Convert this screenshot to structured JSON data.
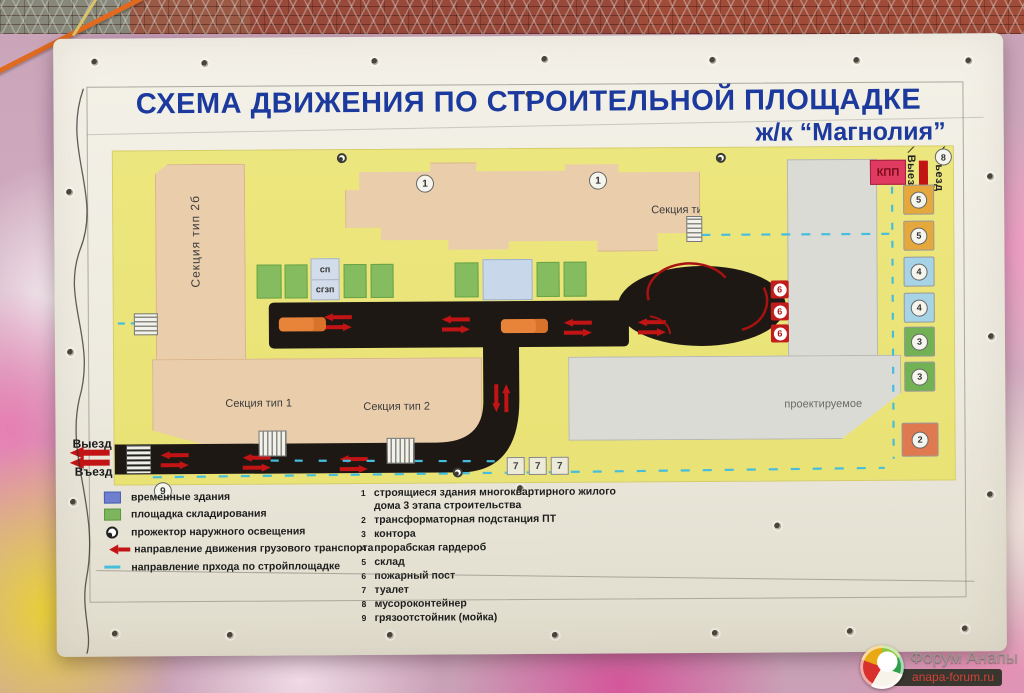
{
  "title": {
    "line1": "СХЕМА ДВИЖЕНИЯ ПО СТРОИТЕЛЬНОЙ ПЛОЩАДКЕ",
    "line2": "ж/к “Магнолия”"
  },
  "map": {
    "section_2b": "Секция тип 2б",
    "section_2a": "Секция тип 2а",
    "section_1": "Секция тип 1",
    "section_2": "Секция тип 2",
    "projected": "проектируемое",
    "sp": "сп",
    "sgzp": "сгзп",
    "kpp": "КПП",
    "gate_top": {
      "exit": "Выезд",
      "entry": "Въезд",
      "badge": "8"
    },
    "gate_left": {
      "exit": "Выезд",
      "entry": "Въезд",
      "badge": "9"
    },
    "building_marks": [
      "1",
      "1"
    ],
    "fire_posts": [
      "6",
      "6",
      "6"
    ],
    "toilets": [
      "7",
      "7",
      "7"
    ],
    "right_boxes": [
      {
        "num": "5",
        "color": "#e4a83c"
      },
      {
        "num": "5",
        "color": "#e4a83c"
      },
      {
        "num": "4",
        "color": "#a6d3e6"
      },
      {
        "num": "4",
        "color": "#a6d3e6"
      },
      {
        "num": "3",
        "color": "#72b254"
      },
      {
        "num": "3",
        "color": "#72b254"
      },
      {
        "num": "2",
        "color": "#df7950"
      }
    ]
  },
  "legend_left": [
    {
      "swatch": "blue-square",
      "label": "временные здания"
    },
    {
      "swatch": "green-square",
      "label": "площадка складирования"
    },
    {
      "swatch": "floodlight",
      "label": "прожектор наружного освещения"
    },
    {
      "swatch": "red-arrow",
      "label": "направление движения грузового транспорта"
    },
    {
      "swatch": "blue-dash",
      "label": "направление прхода по стройплощадке"
    }
  ],
  "legend_right": [
    {
      "num": "1",
      "label": "строящиеся здания многоквартирного жилого дома 3 этапа строительства"
    },
    {
      "num": "2",
      "label": "трансформаторная подстанция ПТ"
    },
    {
      "num": "3",
      "label": "контора"
    },
    {
      "num": "4",
      "label": "прорабская гардероб"
    },
    {
      "num": "5",
      "label": "склад"
    },
    {
      "num": "6",
      "label": "пожарный пост"
    },
    {
      "num": "7",
      "label": "туалет"
    },
    {
      "num": "8",
      "label": "мусороконтейнер"
    },
    {
      "num": "9",
      "label": "грязоотстойник (мойка)"
    }
  ],
  "watermark": {
    "line1": "Форум Анапы",
    "line2": "anapa-forum.ru"
  },
  "colors": {
    "title_blue": "#1c3a9e",
    "map_yellow": "#ece67e",
    "road_black": "#1d1813",
    "arrow_red": "#c21414",
    "walk_path_blue": "#45bedd",
    "building_beige": "#eaceac",
    "storage_green": "#85bc60",
    "temp_building_blue": "#6e7fd0",
    "kpp_pink": "#e13a60"
  }
}
